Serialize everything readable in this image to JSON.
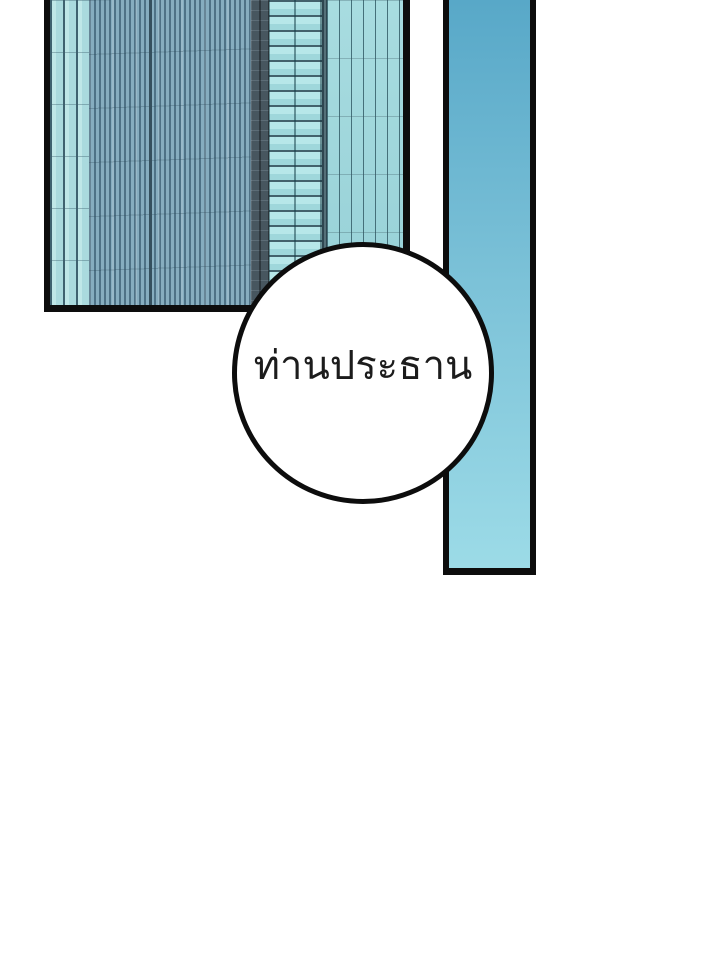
{
  "page": {
    "background_color": "#ffffff",
    "kind": "webtoon-comic-panel"
  },
  "panels": {
    "building_photo": {
      "type": "photo",
      "subject": "glass skyscraper facade close-up",
      "border_color": "#0d0d0d",
      "palette": {
        "light_strip": "#b2e0e4",
        "blue_gray_face": "#7fa8bc",
        "dark_mullion": "#47565f",
        "cyan_bands": "#aee2e5",
        "teal_stripes": "#9fd6da"
      }
    },
    "side_bar": {
      "type": "gradient-strip",
      "border_color": "#0d0d0d",
      "gradient_top": "#58a8c8",
      "gradient_bottom": "#9cdbe7"
    }
  },
  "speech_bubble": {
    "text": "ท่านประธาน",
    "fill_color": "#ffffff",
    "border_color": "#0d0d0d",
    "text_color": "#1c1c1c"
  }
}
